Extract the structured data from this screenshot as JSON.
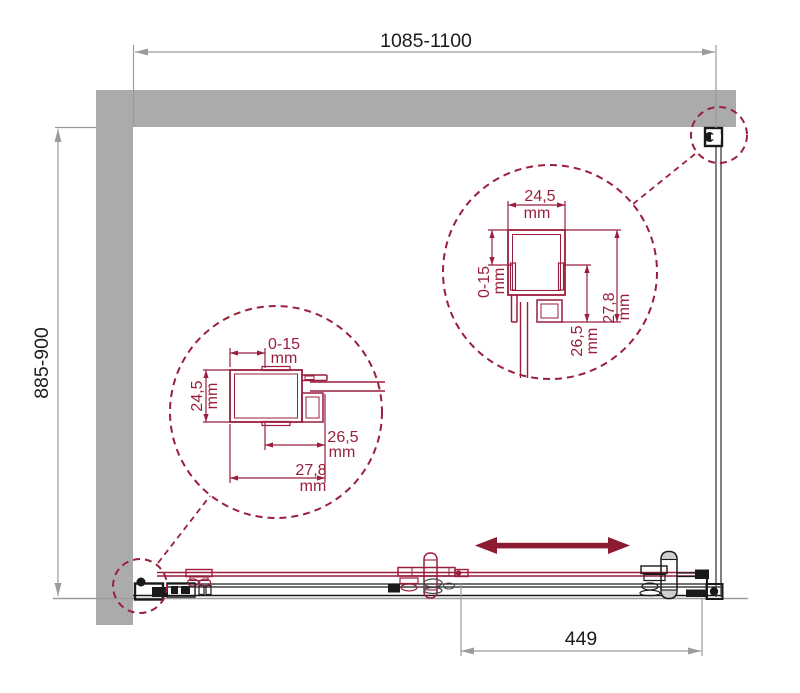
{
  "dimensions": {
    "top_width": "1085-1100",
    "left_height": "885-900",
    "bottom_door": "449"
  },
  "detail_left": {
    "adjust": "0-15",
    "adjust_unit": "mm",
    "height": "24,5",
    "height_unit": "mm",
    "depth_inner": "26,5",
    "depth_inner_unit": "mm",
    "depth_full": "27,8",
    "depth_full_unit": "mm"
  },
  "detail_right": {
    "width": "24,5",
    "width_unit": "mm",
    "adjust": "0-15",
    "adjust_unit": "mm",
    "depth_full": "27,8",
    "depth_full_unit": "mm",
    "depth_inner": "26,5",
    "depth_inner_unit": "mm"
  },
  "colors": {
    "wall": "#ABABAB",
    "dim-line": "#9B9B9B",
    "text": "#1C1C1C",
    "black": "#1A1A1A",
    "red": "#9A1F3D",
    "arrow-red": "#8C1A31"
  }
}
